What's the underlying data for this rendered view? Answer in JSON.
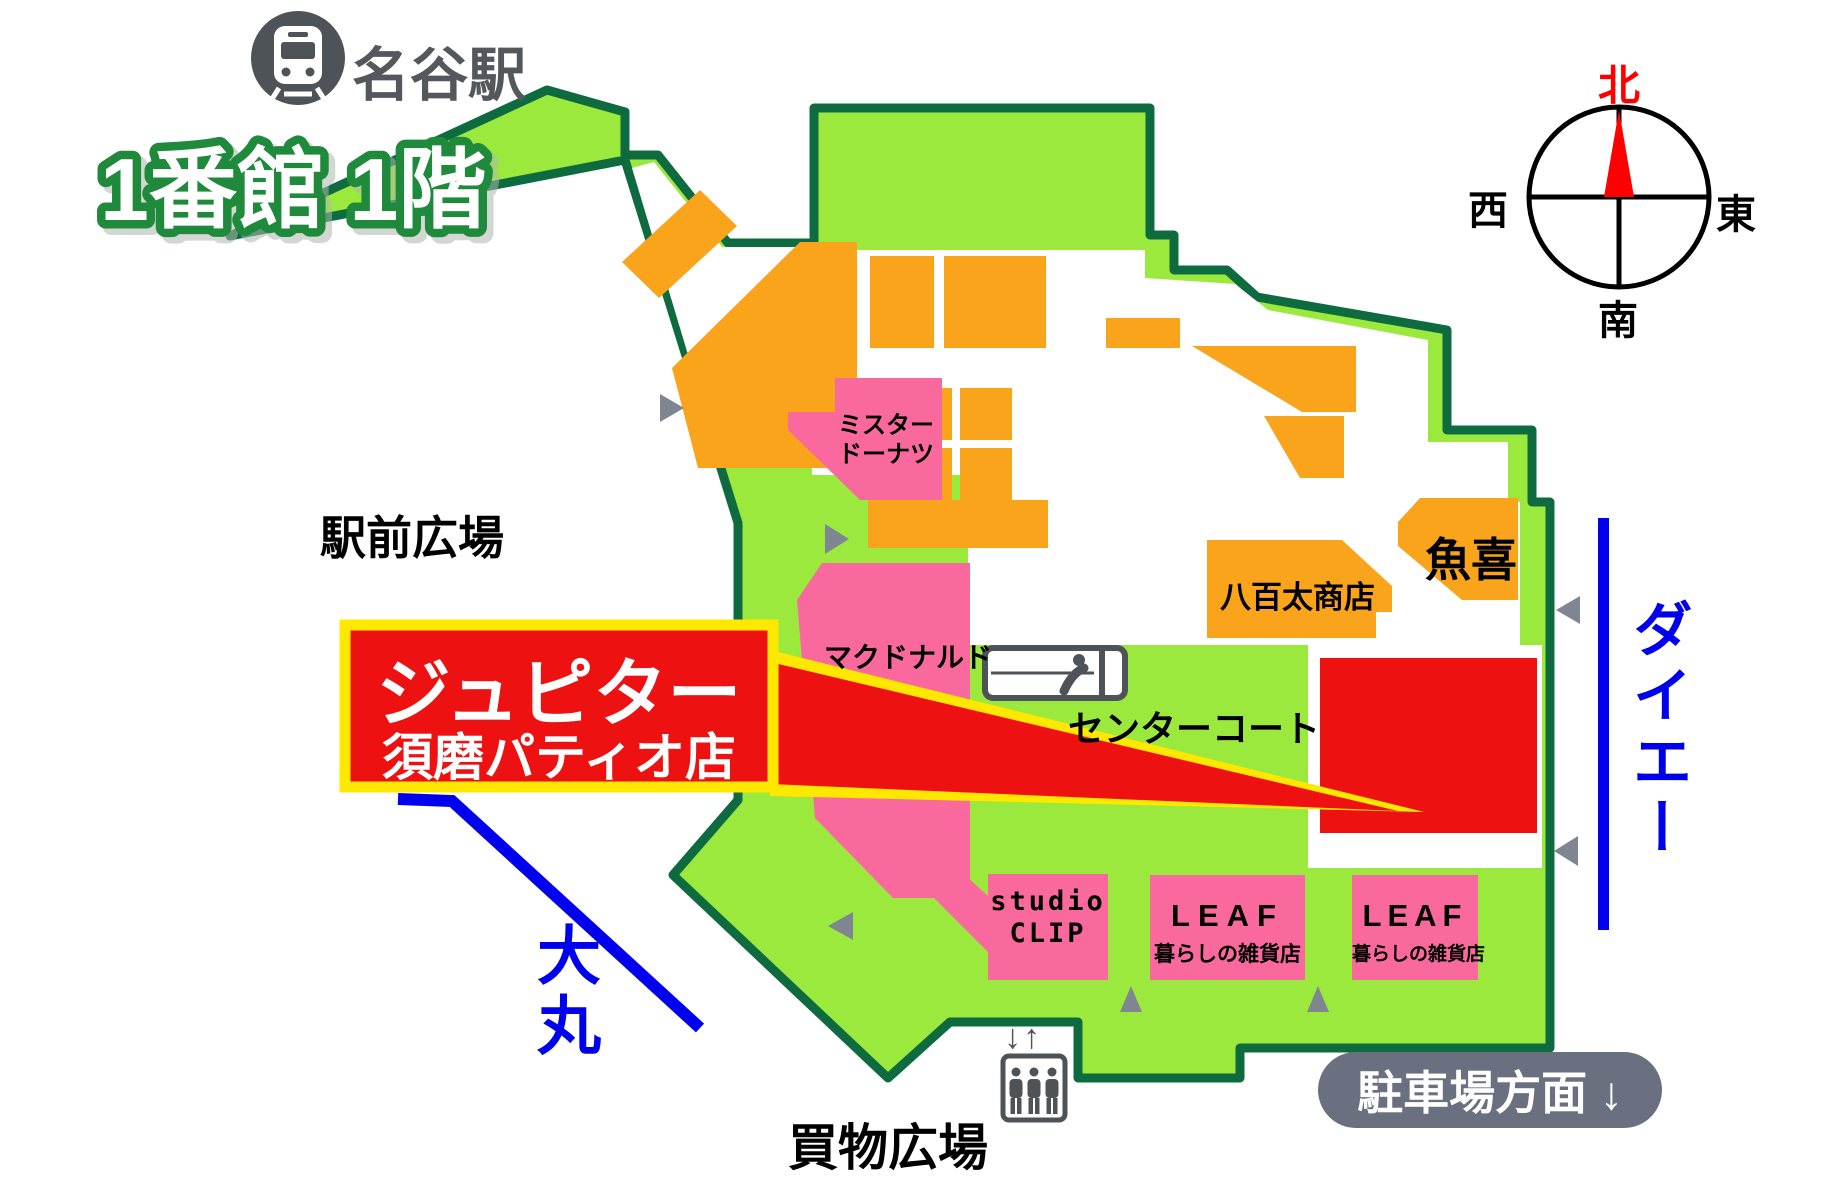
{
  "title": {
    "building_label": "1番館 1階"
  },
  "station": {
    "name": "名谷駅"
  },
  "areas": {
    "station_plaza": "駅前広場",
    "center_court": "センターコート",
    "shopping_plaza": "買物広場"
  },
  "shops": {
    "mister_donut": {
      "line1": "ミスター",
      "line2": "ドーナツ"
    },
    "mcdonalds": {
      "name": "マクドナルド"
    },
    "yaota": {
      "name": "八百太商店"
    },
    "uoki": {
      "name": "魚喜"
    },
    "studio_clip": {
      "line1": "studio",
      "line2": "CLIP"
    },
    "leaf_1": {
      "name": "LEAF",
      "subtitle": "暮らしの雑貨店"
    },
    "leaf_2": {
      "name": "LEAF",
      "subtitle": "暮らしの雑貨店"
    }
  },
  "highlight": {
    "store_line1": "ジュピター",
    "store_line2": "須磨パティオ店"
  },
  "neighbors": {
    "daiei": "ダイエー",
    "daimaru": "大丸"
  },
  "signs": {
    "parking": "駐車場方面 ↓"
  },
  "compass": {
    "north": "北",
    "south": "南",
    "east": "東",
    "west": "西"
  },
  "elevator": {
    "arrows": "↓↑"
  },
  "colors": {
    "map_green": "#9BE93D",
    "map_border": "#0E6B40",
    "shop_orange": "#F9A41B",
    "shop_pink": "#F9699E",
    "highlight_red": "#ED1111",
    "highlight_yellow": "#FFE800",
    "link_blue": "#0000EE",
    "icon_gray": "#4E5357",
    "arrow_gray": "#808691",
    "badge_gray": "#6A7080",
    "heading_green": "#1F8A3B",
    "compass_red": "#FF0000",
    "label_black": "#000000"
  }
}
